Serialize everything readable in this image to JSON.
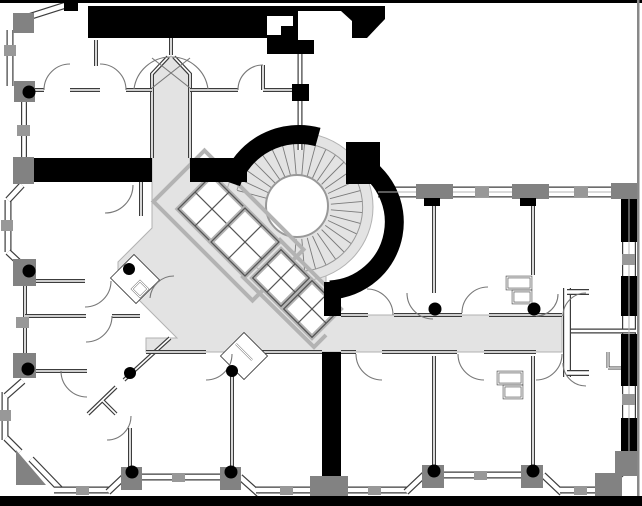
{
  "meta": {
    "title": "Architectural floor plan",
    "drawing_type": "building storey plan with highlighted circulation corridor",
    "visible_text": []
  },
  "colors": {
    "bg": "#ffffff",
    "wall": "#000000",
    "floor": "#e3e3e3",
    "flooredge": "#b2b2b2",
    "thin": "#3c3c3c",
    "pier": "#828282",
    "mull": "#989898",
    "shaft": "#b3b3b3",
    "tread": "#7a7a7a",
    "arcc": "#777777",
    "frame": "#888888"
  },
  "inventory": {
    "corridor": "L-shaped gray-highlighted corridor: vertical entry at top, diagonal run past elevator bank, horizontal run to east wing",
    "elevator_shafts": 4,
    "elevator_symbol": "rotated square with X",
    "curved_stair": 1,
    "stair_treads_fan": true,
    "structural_columns": 12,
    "door_swings": 22,
    "window_piers_gray": 16,
    "window_mullion_blocks": 15,
    "bay_windows": "octagonal bays at west corners, zigzag bay band along south wall",
    "black_wall_masses": "north service core with stair shaft, mid horizontal wall, vertical wall south of core, east facade piers, south border bar"
  },
  "stair": {
    "cx": 299,
    "cy": 207,
    "r_inner": 32,
    "r_outer": 64,
    "angle_start": -165,
    "angle_end": 95,
    "angle_step": 10
  }
}
